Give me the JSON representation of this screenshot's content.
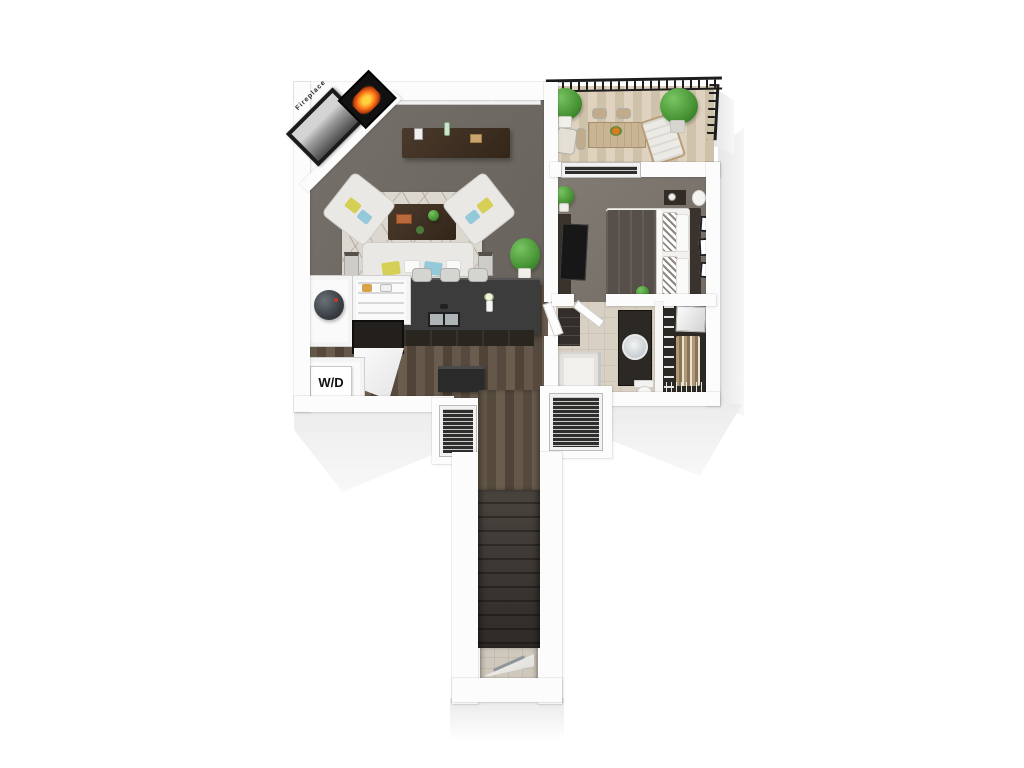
{
  "floorplan": {
    "labels": {
      "fireplace": "Fireplace",
      "washer_dryer": "W/D"
    },
    "colors": {
      "background": "#ffffff",
      "wall": "#fcfcfc",
      "wall_shade": "#e8e8e8",
      "living_carpet": "#6e6962",
      "bedroom_carpet": "#7b746c",
      "wood_floor": "#5e5144",
      "balcony_deck": "#d8cbb6",
      "bathroom_tile": "#d8d0c2",
      "closet_floor": "#2c2824",
      "island_counter": "#3c3c3c",
      "railing": "#1d1d1d",
      "stair_steps": "#46403b",
      "fire_glow": "#ff7a1a",
      "plant_green": "#479434",
      "pillow_yellow": "#d6cf56",
      "pillow_blue": "#93c9d8",
      "sofa": "#e9e8e4",
      "bed_duvet": "#57504a"
    }
  }
}
